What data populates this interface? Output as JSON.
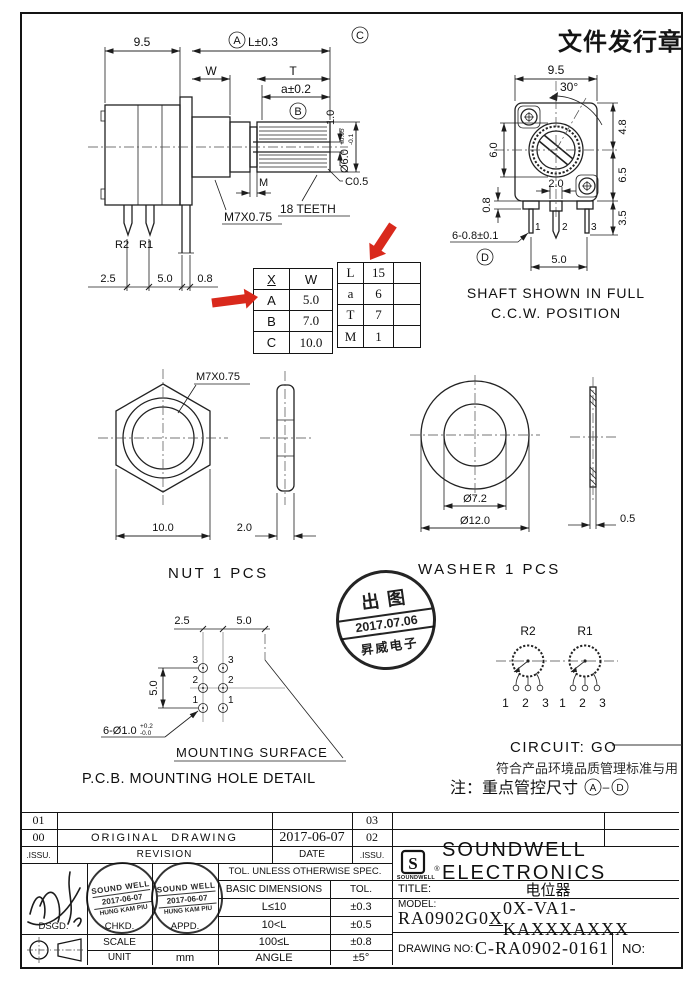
{
  "colors": {
    "arrow_red": "#d9291c",
    "ink": "#141414"
  },
  "doc_stamp": "文件发行章",
  "side_view": {
    "dim_9_5": "9.5",
    "label_a": "A",
    "dim_l": "L±0.3",
    "dim_w": "W",
    "dim_t": "T",
    "dim_a": "a±0.2",
    "label_b": "B",
    "label_c": "C",
    "dim_1_0": "1.0",
    "dim_dia": "Ø6.0",
    "dia_tol_up": "+0.05",
    "dia_tol_dn": "-0.1",
    "dim_m": "M",
    "thread": "M7X0.75",
    "teeth": "18 TEETH",
    "chamfer": "C0.5",
    "pin_r2": "R2",
    "pin_r1": "R1",
    "dim_2_5": "2.5",
    "dim_5_0": "5.0",
    "dim_0_8": "0.8"
  },
  "front_view": {
    "dim_9_5": "9.5",
    "dim_30": "30°",
    "dim_4_8": "4.8",
    "dim_6_0": "6.0",
    "dim_6_5": "6.5",
    "dim_2_0": "2.0",
    "dim_0_8": "0.8",
    "dim_3_5": "3.5",
    "pin1": "1",
    "pin2": "2",
    "pin3": "3",
    "dim_pins": "6-0.8±0.1",
    "label_d": "D",
    "dim_5_0": "5.0",
    "caption1": "SHAFT SHOWN IN FULL",
    "caption2": "C.C.W. POSITION"
  },
  "size_table": {
    "col1": "X",
    "col2": "W",
    "rows": [
      [
        "A",
        "5.0"
      ],
      [
        "B",
        "7.0"
      ],
      [
        "C",
        "10.0"
      ]
    ]
  },
  "param_table": {
    "rows": [
      [
        "L",
        "15"
      ],
      [
        "a",
        "6"
      ],
      [
        "T",
        "7"
      ],
      [
        "M",
        "1"
      ]
    ]
  },
  "nut": {
    "thread": "M7X0.75",
    "dim_10": "10.0",
    "dim_2": "2.0",
    "caption": "NUT 1 PCS"
  },
  "washer": {
    "dim_inner": "Ø7.2",
    "dim_outer": "Ø12.0",
    "dim_0_5": "0.5",
    "caption": "WASHER 1 PCS"
  },
  "release_stamp": {
    "top": "出图",
    "date": "2017.07.06",
    "bottom": "昇威电子"
  },
  "pcb": {
    "dim_2_5": "2.5",
    "dim_5_0h": "5.0",
    "dim_5_0v": "5.0",
    "hole_note": "6-Ø1.0",
    "hole_tol_up": "+0.2",
    "hole_tol_dn": "-0.0",
    "left_pins": [
      "3",
      "2",
      "1"
    ],
    "right_pins": [
      "3",
      "2",
      "1"
    ],
    "surface": "MOUNTING SURFACE",
    "caption": "P.C.B. MOUNTING HOLE DETAIL"
  },
  "circuit": {
    "r2": "R2",
    "r1": "R1",
    "pins": "1 2 3",
    "label": "CIRCUIT: GO",
    "note1": "符合产品环境品质管理标准与用",
    "note2_prefix": "注：重点管控尺寸",
    "note2_a": "A",
    "note2_dash": "–",
    "note2_d": "D"
  },
  "revision": {
    "r1_issu": "01",
    "r1_rev": "",
    "r1_date": "",
    "r1_issu2": "03",
    "r2_issu": "00",
    "r2_rev": "ORIGINAL DRAWING",
    "r2_date": "2017-06-07",
    "r2_issu2": "02",
    "h_issu": ".ISSU.",
    "h_revision": "REVISION",
    "h_date": "DATE",
    "h_issu2": ".ISSU."
  },
  "title_block": {
    "company": "SOUNDWELL ELECTRONICS",
    "logo_letter": "S",
    "logo_text": "SOUNDWELL",
    "registered": "®",
    "title_label": "TITLE:",
    "title_value": "电位器",
    "model_label": "MODEL:",
    "model_pre": "RA0902G0",
    "model_x": "X",
    "model_post": "0X-VA1-KAXXXAXXX",
    "drawing_label": "DRAWING NO:",
    "drawing_value": "C-RA0902-0161",
    "no_label": "NO:",
    "tol_header": "TOL. UNLESS OTHERWISE SPEC.",
    "tol_col1": "BASIC DIMENSIONS",
    "tol_col2": "TOL.",
    "tol_rows": [
      [
        "L≤10",
        "±0.3"
      ],
      [
        "10<L",
        "±0.5"
      ],
      [
        "100≤L",
        "±0.8"
      ],
      [
        "ANGLE",
        "±5°"
      ]
    ],
    "dsgd": "DSGD.",
    "chkd": "CHKD.",
    "appd": "APPD.",
    "scale": "SCALE",
    "unit": "UNIT",
    "unit_value": "mm",
    "stamp_line1": "SOUND WELL",
    "stamp_line2": "2017-06-07",
    "stamp_line3": "HUNG KAM PIU"
  }
}
